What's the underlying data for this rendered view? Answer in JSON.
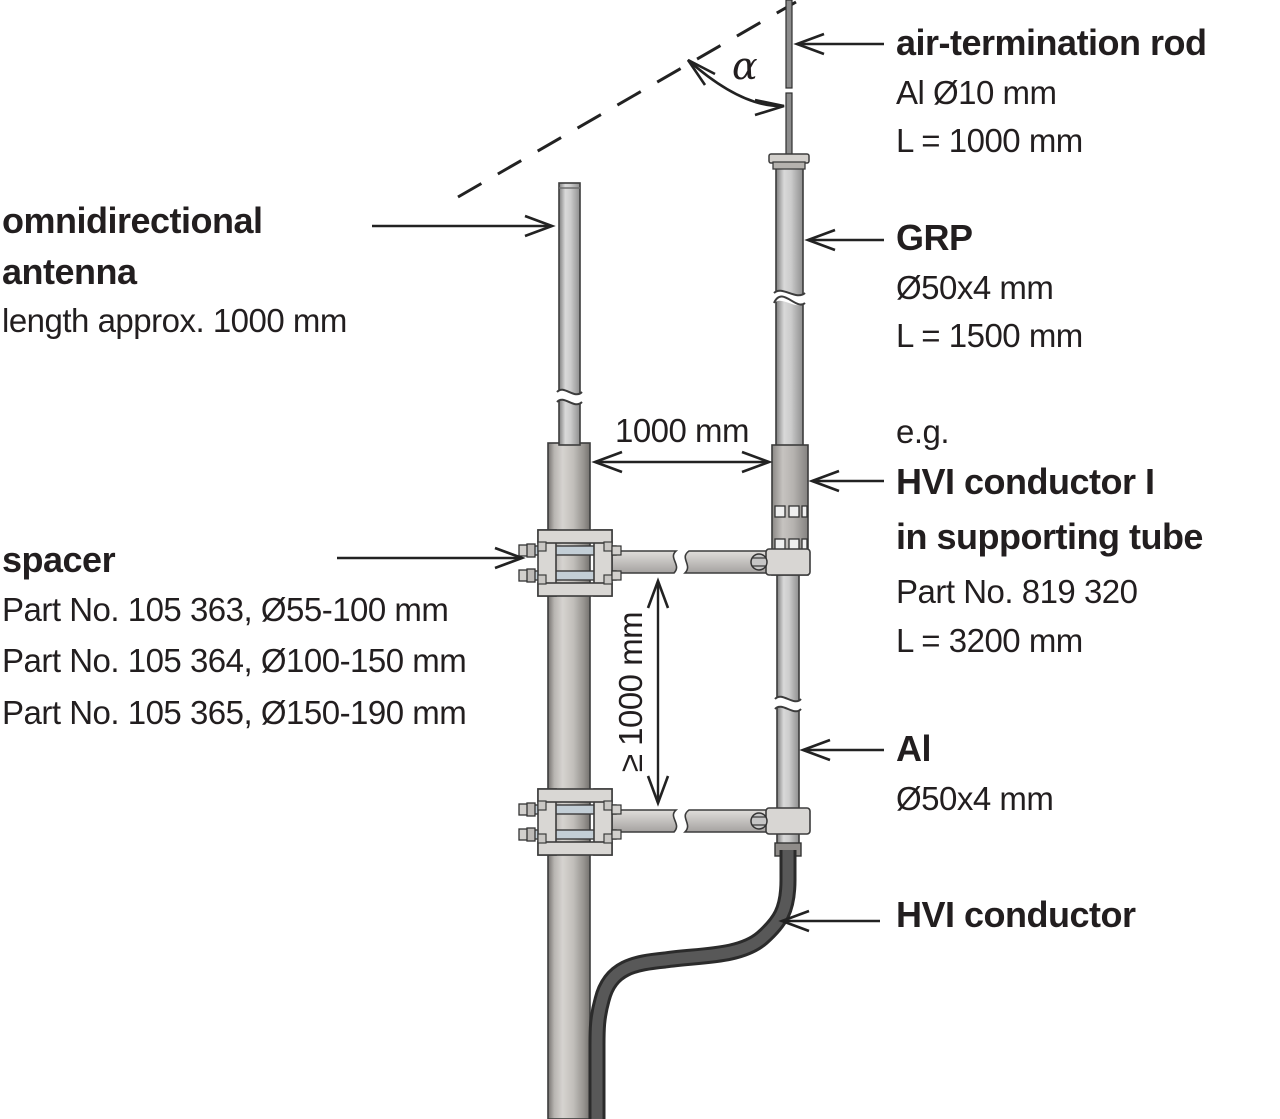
{
  "labels": {
    "antenna": {
      "title_line1": "omnidirectional",
      "title_line2": "antenna",
      "detail": "length approx. 1000 mm"
    },
    "spacer": {
      "title": "spacer",
      "parts": [
        "Part No. 105 363, Ø55-100 mm",
        "Part No. 105 364, Ø100-150 mm",
        "Part No. 105 365, Ø150-190 mm"
      ]
    },
    "air_termination_rod": {
      "title": "air-termination rod",
      "detail1": "Al Ø10 mm",
      "detail2": "L = 1000 mm"
    },
    "grp": {
      "title": "GRP",
      "detail1": "Ø50x4 mm",
      "detail2": "L = 1500 mm"
    },
    "hvi_in_tube": {
      "prefix": "e.g.",
      "title_line1": "HVI conductor I",
      "title_line2": "in supporting tube",
      "detail1": "Part No. 819 320",
      "detail2": "L = 3200 mm"
    },
    "al_tube": {
      "title": "Al",
      "detail1": "Ø50x4 mm"
    },
    "hvi_conductor": {
      "title": "HVI conductor"
    }
  },
  "dimensions": {
    "horizontal_spacing": "1000 mm",
    "vertical_spacing": "≥ 1000 mm",
    "protection_angle": "α"
  },
  "colors": {
    "text": "#221e1f",
    "line": "#222222",
    "tube_light_gray": "#c9c7c4",
    "mast_gray": "#b5b1ad",
    "cable_dark_gray": "#4a4a4a"
  }
}
